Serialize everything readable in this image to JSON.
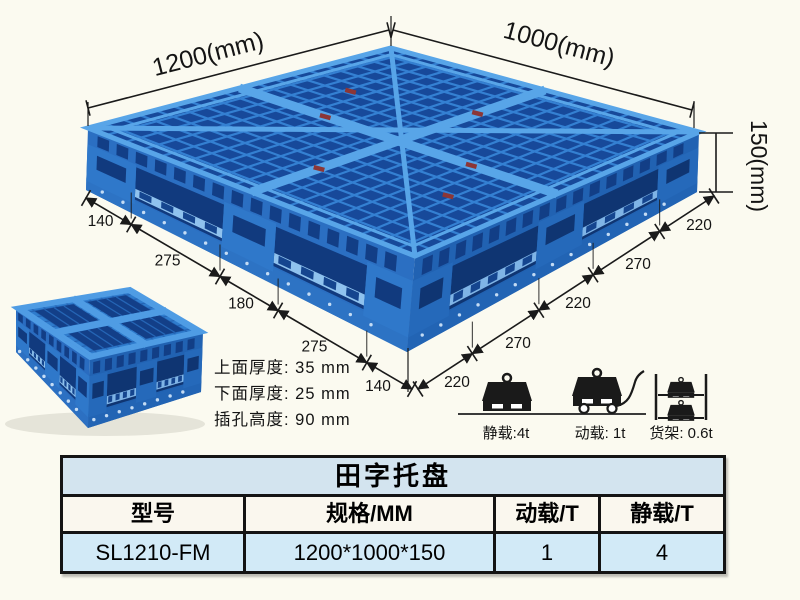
{
  "dimensions": {
    "top_width_label": "1200(mm)",
    "top_depth_label": "1000(mm)",
    "height_label": "150(mm)",
    "left_chain": [
      "140",
      "275",
      "180",
      "275",
      "140"
    ],
    "right_chain": [
      "220",
      "270",
      "220",
      "270",
      "220"
    ]
  },
  "thickness_notes": {
    "line1": "上面厚度: 35 mm",
    "line2": "下面厚度: 25 mm",
    "line3": "插孔高度: 90 mm"
  },
  "load_ratings": {
    "static": {
      "icon": "static-load-weight-icon",
      "label": "静载:4t"
    },
    "dynamic": {
      "icon": "dynamic-load-trolley-icon",
      "label": "动载: 1t"
    },
    "rack": {
      "icon": "rack-shelf-load-icon",
      "label": "货架: 0.6t"
    }
  },
  "table": {
    "title": "田字托盘",
    "headers": [
      "型号",
      "规格/MM",
      "动载/T",
      "静载/T"
    ],
    "rows": [
      [
        "SL1210-FM",
        "1200*1000*150",
        "1",
        "4"
      ]
    ]
  },
  "colors": {
    "pallet_blue": "#2e79cc",
    "pallet_dark_blue": "#17499a",
    "pallet_light_blue": "#58a5e8",
    "table_title_bg": "#d3e4ef",
    "table_data_bg": "#d2eaf7",
    "line_color": "#1a1a1a",
    "background": "#fbfaf0"
  }
}
